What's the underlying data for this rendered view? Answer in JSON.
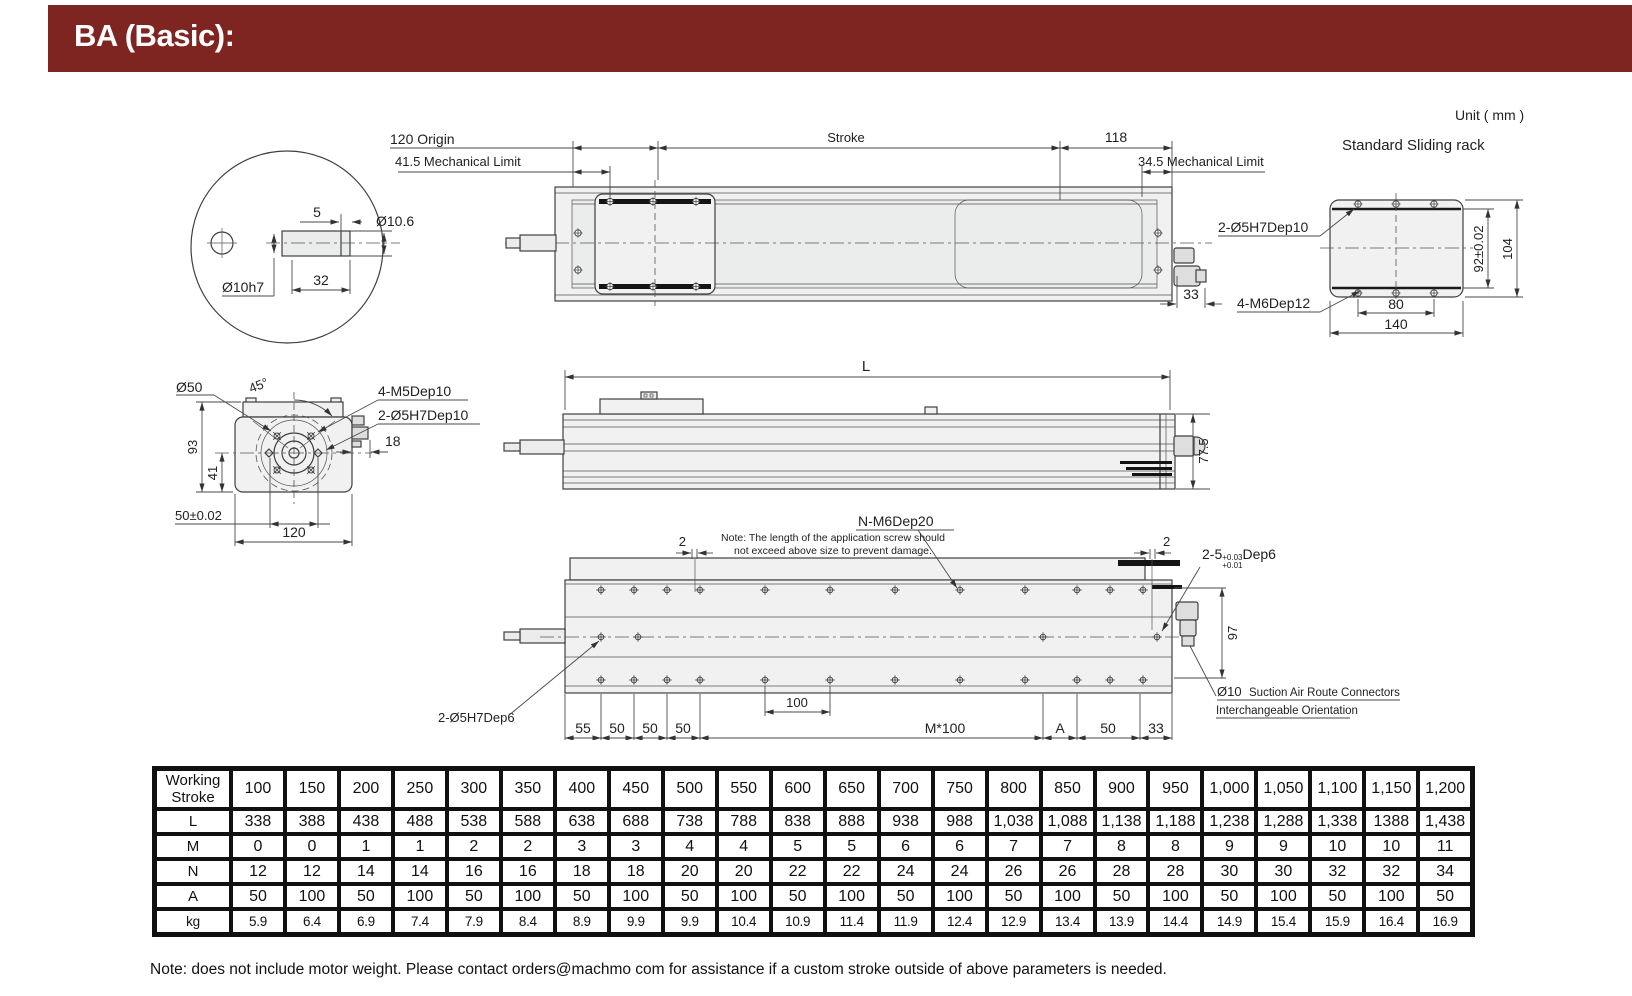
{
  "header": {
    "title": "BA (Basic):"
  },
  "meta": {
    "unit": "Unit ( mm )",
    "rack_title": "Standard Sliding rack"
  },
  "shaft_view": {
    "dim_5": "5",
    "dia_shaft_tip": "Ø10.6",
    "dia_shaft": "Ø10h7",
    "dim_32": "32"
  },
  "top_view": {
    "origin": "120 Origin",
    "mech_limit_left": "41.5 Mechanical Limit",
    "stroke": "Stroke",
    "dim_118": "118",
    "mech_limit_right": "34.5 Mechanical Limit",
    "dim_33": "33"
  },
  "rack_view": {
    "pin_label": "2-Ø5H7Dep10",
    "screw_label": "4-M6Dep12",
    "dim_92": "92±0.02",
    "dim_104": "104",
    "dim_80": "80",
    "dim_140": "140"
  },
  "end_view": {
    "dia_50": "Ø50",
    "angle": "45°",
    "screw_label": "4-M5Dep10",
    "pin_label": "2-Ø5H7Dep10",
    "dim_18": "18",
    "dim_93": "93",
    "dim_41": "41",
    "dim_50": "50±0.02",
    "dim_120": "120"
  },
  "side_view": {
    "dim_L": "L",
    "dim_77_5": "77.5"
  },
  "bottom_view": {
    "screw_label": "N-M6Dep20",
    "note_line1": "Note: The length of the application screw should",
    "note_line2": "not exceed above size to prevent damage.",
    "dim_2_left": "2",
    "dim_2_right": "2",
    "pin_label_left": "2-Ø5H7Dep6",
    "pin_right_prefix": "2-5",
    "pin_right_tol_upper": "+0.03",
    "pin_right_tol_lower": "+0.01",
    "pin_right_suffix": "Dep6",
    "dim_97": "97",
    "dia_10": "Ø10",
    "suction_label": "Suction Air Route Connectors",
    "orientation_label": "Interchangeable Orientation",
    "dims": {
      "d55": "55",
      "d50a": "50",
      "d50b": "50",
      "d50c": "50",
      "d100": "100",
      "dM": "M*100",
      "dA": "A",
      "d50d": "50",
      "d33": "33"
    }
  },
  "table": {
    "rows": [
      {
        "label": "Working Stroke",
        "values": [
          "100",
          "150",
          "200",
          "250",
          "300",
          "350",
          "400",
          "450",
          "500",
          "550",
          "600",
          "650",
          "700",
          "750",
          "800",
          "850",
          "900",
          "950",
          "1,000",
          "1,050",
          "1,100",
          "1,150",
          "1,200"
        ]
      },
      {
        "label": "L",
        "values": [
          "338",
          "388",
          "438",
          "488",
          "538",
          "588",
          "638",
          "688",
          "738",
          "788",
          "838",
          "888",
          "938",
          "988",
          "1,038",
          "1,088",
          "1,138",
          "1,188",
          "1,238",
          "1,288",
          "1,338",
          "1388",
          "1,438"
        ]
      },
      {
        "label": "M",
        "values": [
          "0",
          "0",
          "1",
          "1",
          "2",
          "2",
          "3",
          "3",
          "4",
          "4",
          "5",
          "5",
          "6",
          "6",
          "7",
          "7",
          "8",
          "8",
          "9",
          "9",
          "10",
          "10",
          "11"
        ]
      },
      {
        "label": "N",
        "values": [
          "12",
          "12",
          "14",
          "14",
          "16",
          "16",
          "18",
          "18",
          "20",
          "20",
          "22",
          "22",
          "24",
          "24",
          "26",
          "26",
          "28",
          "28",
          "30",
          "30",
          "32",
          "32",
          "34"
        ]
      },
      {
        "label": "A",
        "values": [
          "50",
          "100",
          "50",
          "100",
          "50",
          "100",
          "50",
          "100",
          "50",
          "100",
          "50",
          "100",
          "50",
          "100",
          "50",
          "100",
          "50",
          "100",
          "50",
          "100",
          "50",
          "100",
          "50"
        ]
      },
      {
        "label": "kg",
        "values": [
          "5.9",
          "6.4",
          "6.9",
          "7.4",
          "7.9",
          "8.4",
          "8.9",
          "9.9",
          "9.9",
          "10.4",
          "10.9",
          "11.4",
          "11.9",
          "12.4",
          "12.9",
          "13.4",
          "13.9",
          "14.4",
          "14.9",
          "15.4",
          "15.9",
          "16.4",
          "16.9"
        ]
      }
    ]
  },
  "footnote": "Note: does not include motor weight. Please contact orders@machmo com for assistance if a custom stroke outside of above parameters is needed."
}
